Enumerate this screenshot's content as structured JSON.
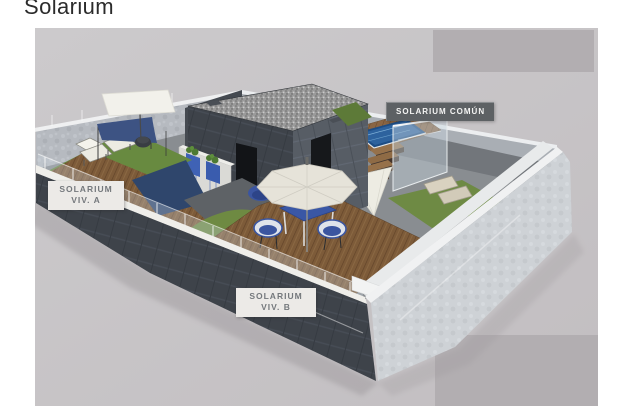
{
  "title": {
    "text": "Solarium"
  },
  "labels": {
    "comun": {
      "text": "SOLARIUM COMÚN"
    },
    "viv_a": {
      "line1": "SOLARIUM",
      "line2": "VIV. A"
    },
    "viv_b": {
      "line1": "SOLARIUM",
      "line2": "VIV. B"
    }
  },
  "colors": {
    "page_background": "#ffffff",
    "render_background": "#c8c4c7",
    "corner_rectangles": "#b2aeb1",
    "dark_wall": "#3e434a",
    "light_wall": "#ced2d6",
    "wall_cap": "#efeeea",
    "wood_deck": "#7d5b39",
    "grass": "#6e8a42",
    "pool_water": "#1d4d85",
    "accent_blue_furniture": "#3a57a5",
    "umbrella_canopy": "#e6e3d9",
    "label_dark_bg": "#5d6164",
    "label_light_bg": "#eceae7"
  }
}
